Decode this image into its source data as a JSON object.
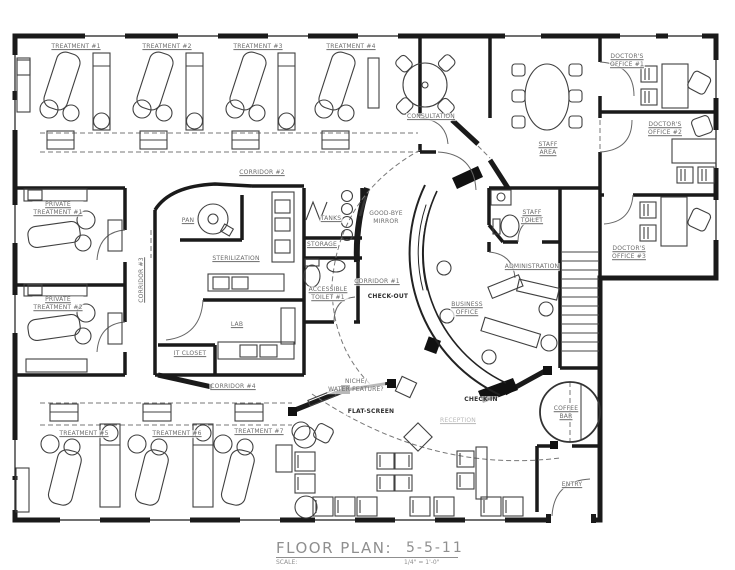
{
  "colors": {
    "wall": "#1a1a1a",
    "furniture": "#404040",
    "label": "#6b6b6b",
    "label_dark": "#2f2f2f",
    "label_light": "#b8b8b8",
    "background": "#ffffff"
  },
  "title_block": {
    "title": "FLOOR PLAN:",
    "scale_label": "SCALE:",
    "date": "5-5-11",
    "scale_value": "1/4\" = 1'-0\""
  },
  "rooms": [
    {
      "id": "treatment-1",
      "text": "TREATMENT #1",
      "x": 76,
      "y": 47,
      "ul": true
    },
    {
      "id": "treatment-2",
      "text": "TREATMENT #2",
      "x": 167,
      "y": 47,
      "ul": true
    },
    {
      "id": "treatment-3",
      "text": "TREATMENT #3",
      "x": 258,
      "y": 47,
      "ul": true
    },
    {
      "id": "treatment-4",
      "text": "TREATMENT #4",
      "x": 351,
      "y": 47,
      "ul": true
    },
    {
      "id": "consultation",
      "text": "CONSULTATION",
      "x": 431,
      "y": 117,
      "ul": true
    },
    {
      "id": "staff-area",
      "text": "STAFF\nAREA",
      "x": 548,
      "y": 149,
      "ul": true
    },
    {
      "id": "doctors-office-1",
      "text": "DOCTOR'S\nOFFICE #1",
      "x": 627,
      "y": 61,
      "ul": true
    },
    {
      "id": "doctors-office-2",
      "text": "DOCTOR'S\nOFFICE #2",
      "x": 665,
      "y": 129,
      "ul": true
    },
    {
      "id": "doctors-office-3",
      "text": "DOCTOR'S\nOFFICE #3",
      "x": 629,
      "y": 253,
      "ul": true
    },
    {
      "id": "private-treatment-1",
      "text": "PRIVATE\nTREATMENT #1",
      "x": 58,
      "y": 209,
      "ul": true
    },
    {
      "id": "private-treatment-2",
      "text": "PRIVATE\nTREATMENT #2",
      "x": 58,
      "y": 304,
      "ul": true
    },
    {
      "id": "corridor-1",
      "text": "CORRIDOR #1",
      "x": 377,
      "y": 282,
      "ul": true
    },
    {
      "id": "corridor-2",
      "text": "CORRIDOR #2",
      "x": 262,
      "y": 173,
      "ul": true
    },
    {
      "id": "corridor-3",
      "text": "CORRIDOR #3",
      "x": 142,
      "y": 280,
      "ul": true,
      "rot": true
    },
    {
      "id": "corridor-4",
      "text": "CORRIDOR #4",
      "x": 233,
      "y": 387,
      "ul": true
    },
    {
      "id": "pan",
      "text": "PAN",
      "x": 188,
      "y": 221,
      "ul": true
    },
    {
      "id": "sterilization",
      "text": "STERILIZATION",
      "x": 236,
      "y": 259,
      "ul": true
    },
    {
      "id": "lab",
      "text": "LAB",
      "x": 237,
      "y": 325,
      "ul": true
    },
    {
      "id": "it-closet",
      "text": "IT CLOSET",
      "x": 190,
      "y": 354,
      "ul": true
    },
    {
      "id": "tanks",
      "text": "TANKS",
      "x": 331,
      "y": 219,
      "ul": true
    },
    {
      "id": "storage",
      "text": "STORAGE",
      "x": 322,
      "y": 245,
      "ul": true
    },
    {
      "id": "accessible-toilet-1",
      "text": "ACCESSIBLE\nTOILET #1",
      "x": 328,
      "y": 294,
      "ul": true
    },
    {
      "id": "goodbye-mirror",
      "text": "GOOD-BYE\nMIRROR",
      "x": 386,
      "y": 218,
      "ul": false
    },
    {
      "id": "check-out",
      "text": "CHECK-OUT",
      "x": 388,
      "y": 297,
      "ul": false,
      "tone": "dark"
    },
    {
      "id": "business-office",
      "text": "BUSINESS\nOFFICE",
      "x": 467,
      "y": 309,
      "ul": true
    },
    {
      "id": "staff-toilet",
      "text": "STAFF\nTOILET",
      "x": 532,
      "y": 217,
      "ul": true
    },
    {
      "id": "administration",
      "text": "ADMINISTRATION",
      "x": 532,
      "y": 267,
      "ul": true
    },
    {
      "id": "treatment-5",
      "text": "TREATMENT #5",
      "x": 84,
      "y": 434,
      "ul": true
    },
    {
      "id": "treatment-6",
      "text": "TREATMENT #6",
      "x": 177,
      "y": 434,
      "ul": true
    },
    {
      "id": "treatment-7",
      "text": "TREATMENT #7",
      "x": 259,
      "y": 432,
      "ul": true
    },
    {
      "id": "niche-water-feature",
      "text": "NICHE/\nWATER FEATURE?",
      "x": 356,
      "y": 386,
      "ul": false
    },
    {
      "id": "flat-screen",
      "text": "FLAT-SCREEN",
      "x": 371,
      "y": 412,
      "ul": false,
      "tone": "dark"
    },
    {
      "id": "check-in",
      "text": "CHECK-IN",
      "x": 481,
      "y": 400,
      "ul": false,
      "tone": "dark"
    },
    {
      "id": "reception",
      "text": "RECEPTION",
      "x": 458,
      "y": 421,
      "ul": true,
      "tone": "light"
    },
    {
      "id": "coffee-bar",
      "text": "COFFEE\nBAR",
      "x": 566,
      "y": 413,
      "ul": true
    },
    {
      "id": "entry",
      "text": "ENTRY",
      "x": 572,
      "y": 485,
      "ul": true
    }
  ]
}
